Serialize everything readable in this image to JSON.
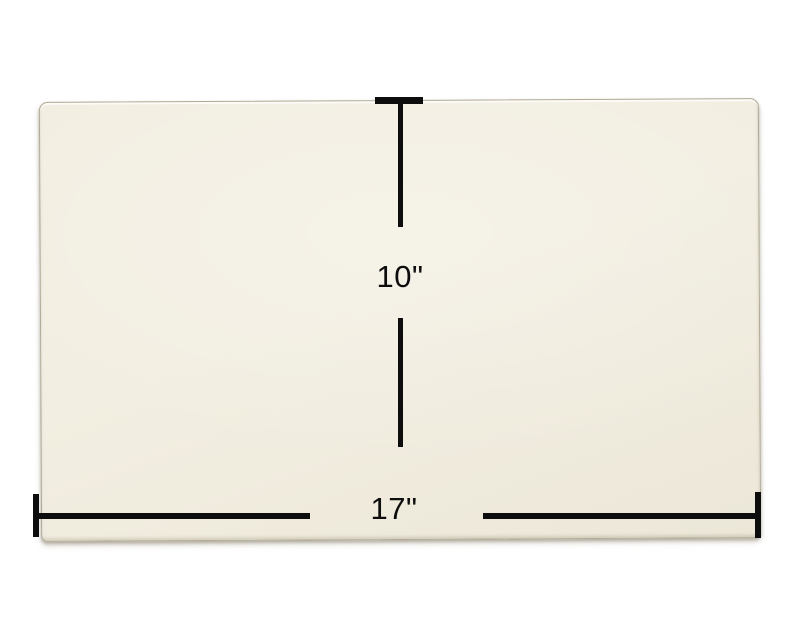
{
  "canvas": {
    "background": "#ffffff"
  },
  "panel": {
    "description": "ceramic-glass-panel",
    "fill_light": "#f2eee1",
    "fill_dark": "#ece7d8",
    "edge_color": "#b2aa95"
  },
  "dimensions": {
    "line_color": "#0d0d0d",
    "height": {
      "label": "10\""
    },
    "width": {
      "label": "17\""
    }
  }
}
